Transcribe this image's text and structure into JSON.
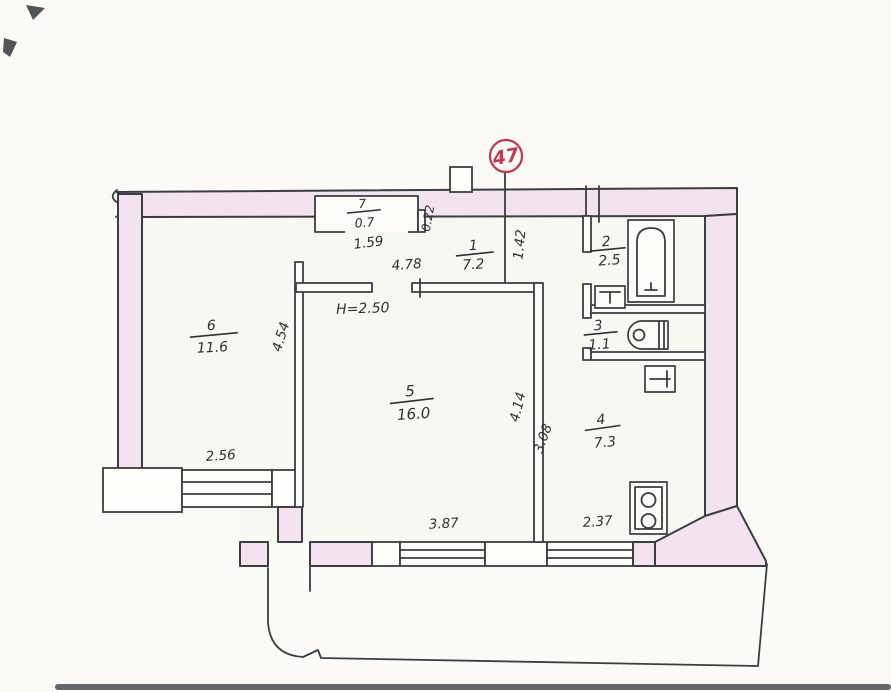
{
  "plan": {
    "stamp_number": "47",
    "height_note": "Н=2.50",
    "rooms": [
      {
        "number": "1",
        "area": "7.2"
      },
      {
        "number": "2",
        "area": "2.5"
      },
      {
        "number": "3",
        "area": "1.1"
      },
      {
        "number": "4",
        "area": "7.3"
      },
      {
        "number": "5",
        "area": "16.0"
      },
      {
        "number": "6",
        "area": "11.6"
      },
      {
        "number": "7",
        "area": "0.7"
      }
    ],
    "dimensions": {
      "closet_width": "1.59",
      "closet_wall": "0.22",
      "hall_width": "4.78",
      "hall_depth": "1.42",
      "room6_depth": "4.54",
      "room6_window": "2.56",
      "room5_width": "3.87",
      "room5_depth": "4.14",
      "kitchen_depth": "3.08",
      "kitchen_width": "2.37"
    },
    "fixtures": [
      "bathtub-icon",
      "bath-sink-icon",
      "toilet-icon",
      "kitchen-sink-icon",
      "stove-icon"
    ],
    "colors": {
      "wall_fill": "#f2e3ee",
      "line": "#3a3e42",
      "stamp": "#c23850"
    }
  }
}
